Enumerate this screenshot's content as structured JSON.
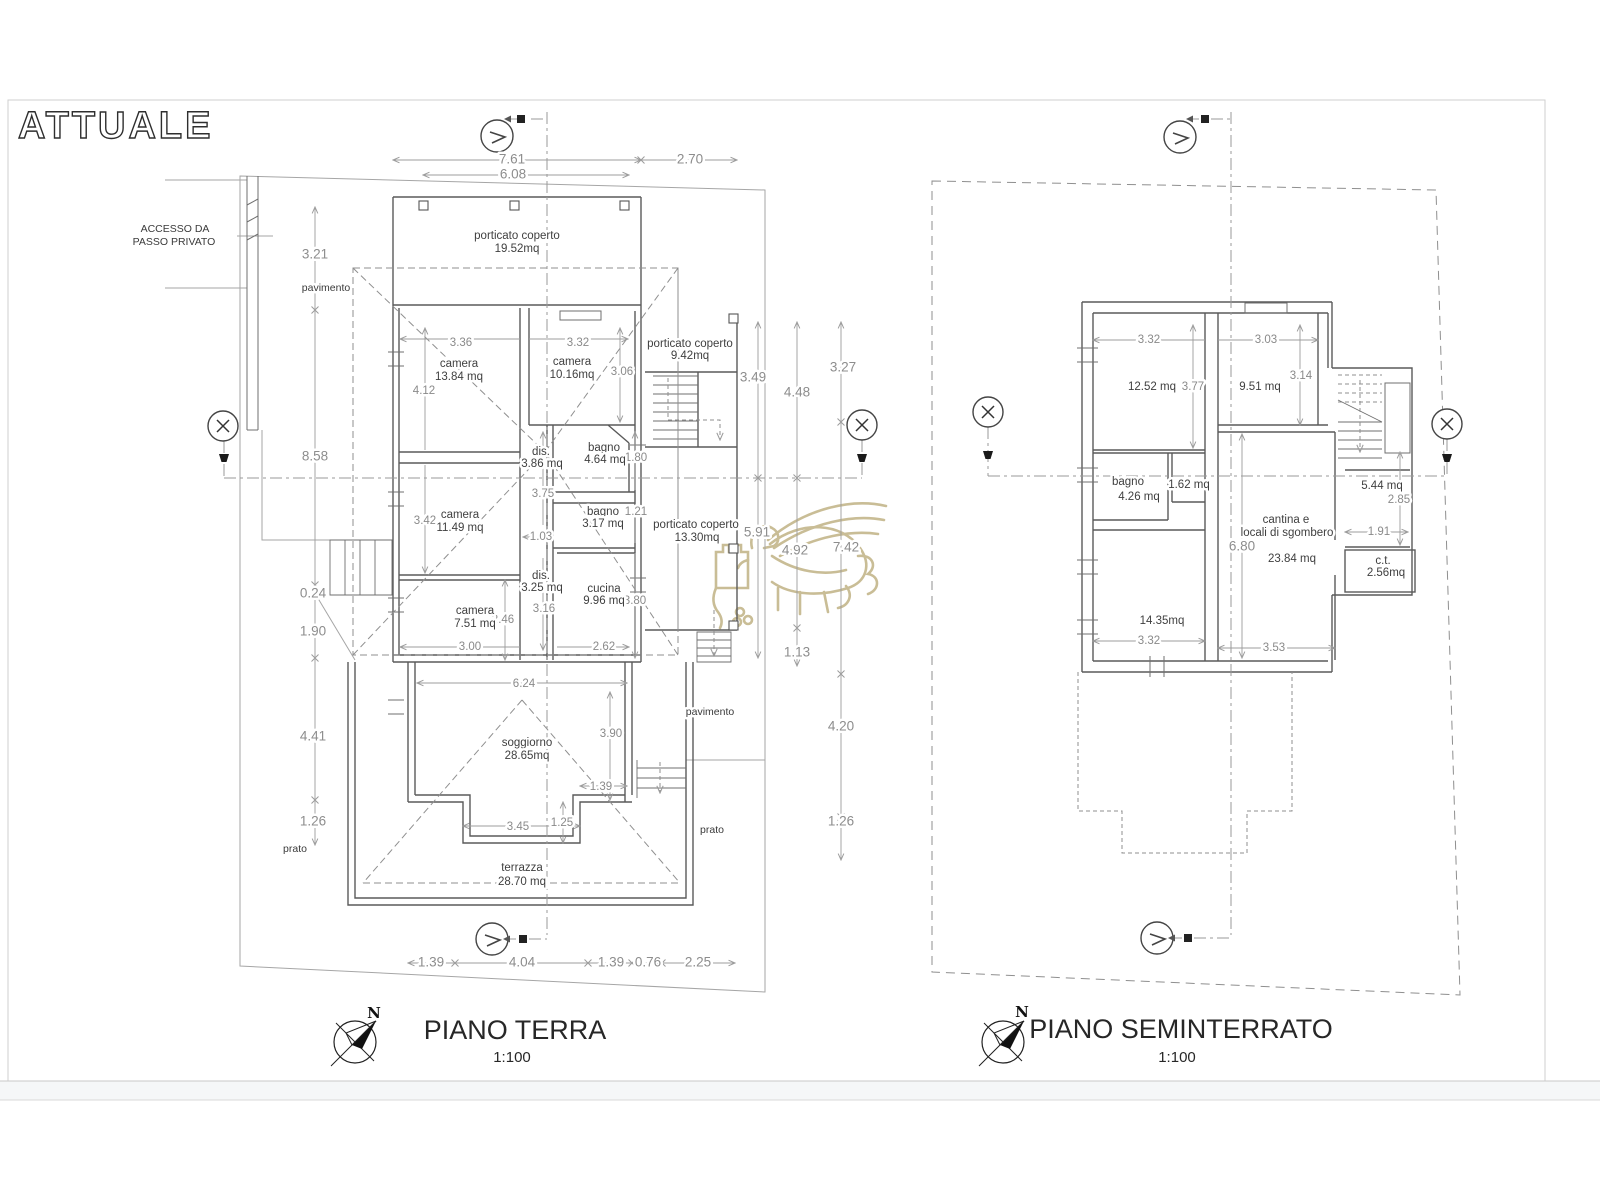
{
  "sheet": {
    "title": "ATTUALE"
  },
  "watermark": {
    "color": "#c9bd96"
  },
  "piano_terra": {
    "title": "PIANO TERRA",
    "scale": "1:100",
    "north_label": "N",
    "site": {
      "accesso_line1": "ACCESSO DA",
      "accesso_line2": "PASSO PRIVATO",
      "pavimento_left": "pavimento",
      "pavimento_right": "pavimento",
      "prato_left": "prato",
      "prato_right": "prato"
    },
    "rooms": {
      "porticato_top": {
        "name": "porticato coperto",
        "area": "19.52mq"
      },
      "porticato_east": {
        "name": "porticato coperto",
        "area": "9.42mq"
      },
      "porticato_mid": {
        "name": "porticato coperto",
        "area": "13.30mq"
      },
      "camera_nw": {
        "name": "camera",
        "area": "13.84 mq"
      },
      "camera_ne": {
        "name": "camera",
        "area": "10.16mq"
      },
      "camera_w": {
        "name": "camera",
        "area": "11.49 mq"
      },
      "camera_sw": {
        "name": "camera",
        "area": "7.51 mq"
      },
      "dis_n": {
        "name": "dis.",
        "area": "3.86 mq"
      },
      "dis_s": {
        "name": "dis.",
        "area": "3.25 mq"
      },
      "bagno_n": {
        "name": "bagno",
        "area": "4.64 mq"
      },
      "bagno_s": {
        "name": "bagno",
        "area": "3.17 mq"
      },
      "cucina": {
        "name": "cucina",
        "area": "9.96 mq"
      },
      "soggiorno": {
        "name": "soggiorno",
        "area": "28.65mq"
      },
      "terrazza": {
        "name": "terrazza",
        "area": "28.70 mq"
      }
    },
    "dims": {
      "top": [
        "7.61",
        "2.70",
        "6.08"
      ],
      "left": [
        "3.21",
        "8.58",
        "0.24",
        "1.90",
        "4.41",
        "1.26"
      ],
      "right": [
        "3.49",
        "4.48",
        "3.27",
        "5.91",
        "4.92",
        "7.42",
        "1.13",
        "4.20",
        "1.26"
      ],
      "bottom": [
        "1.39",
        "4.04",
        "1.39",
        "0.76",
        "2.25"
      ],
      "inner": [
        "3.36",
        "3.32",
        "3.06",
        "4.12",
        "3.42",
        "3.75",
        "1.80",
        "1.21",
        "1.03",
        "3.16",
        "2.46",
        "3.00",
        "2.62",
        "3.80",
        "6.24",
        "3.90",
        "1.39",
        "3.45",
        "1.25"
      ]
    }
  },
  "piano_seminterrato": {
    "title": "PIANO SEMINTERRATO",
    "scale": "1:100",
    "north_label": "N",
    "rooms": {
      "room_nw": {
        "area": "12.52 mq"
      },
      "room_ne": {
        "area": "9.51 mq"
      },
      "bagno": {
        "name": "bagno",
        "area": "4.26 mq"
      },
      "antibagno": {
        "area": "1.62 mq"
      },
      "cantina": {
        "name_line1": "cantina e",
        "name_line2": "locali di sgombero",
        "area": "23.84 mq"
      },
      "scala": {
        "area": "5.44 mq"
      },
      "ct": {
        "name": "c.t.",
        "area": "2.56mq"
      },
      "room_sw": {
        "area": "14.35mq"
      }
    },
    "dims": {
      "inner": [
        "3.32",
        "3.03",
        "3.77",
        "3.14",
        "6.80",
        "2.85",
        "1.91",
        "3.32",
        "3.53"
      ]
    }
  }
}
